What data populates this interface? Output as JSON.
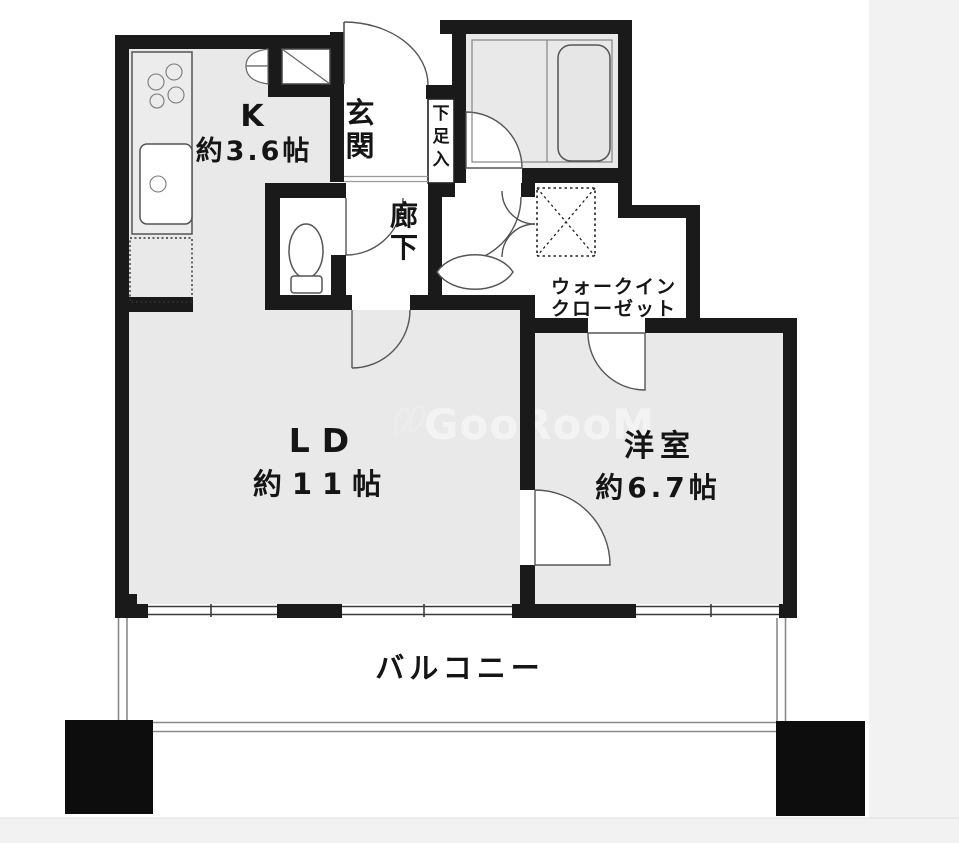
{
  "rooms": {
    "kitchen": {
      "label": "K",
      "size": "約3.6帖"
    },
    "entrance": {
      "label": "玄関"
    },
    "shoe_box": {
      "label": "下足入"
    },
    "hallway": {
      "label": "廊下"
    },
    "walk_in_closet": {
      "line1": "ウォークイン",
      "line2": "クローゼット"
    },
    "living_dining": {
      "label": "LD",
      "size": "約11帖"
    },
    "western_room": {
      "label": "洋室",
      "size": "約6.7帖"
    },
    "balcony": {
      "label": "バルコニー"
    }
  },
  "watermark": {
    "text": "GooRooM"
  },
  "colors": {
    "wall": "#1a1a1a",
    "room_floor": "#e9e9e9",
    "watermark": "#f3f3f3",
    "page_band": "#f2f2f2"
  }
}
